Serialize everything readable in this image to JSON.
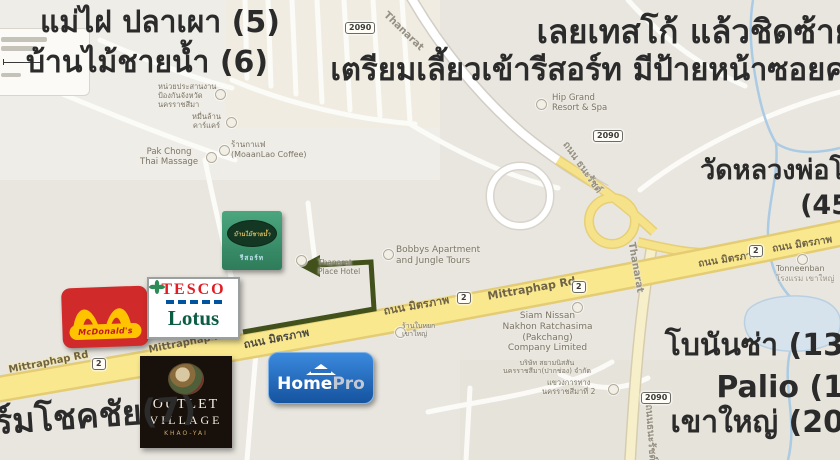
{
  "annotations": {
    "restaurant_5": "แม่ไฝ ปลาเผา (5)",
    "restaurant_6": "บ้านไม้ชายน้ำ (6)",
    "direction_line1": "เลยเทสโก้ แล้วชิดซ้าย",
    "direction_line2": "เตรียมเลี้ยวเข้ารีสอร์ท มีป้ายหน้าซอยค",
    "temple": "วัดหลวงพ่อโ",
    "temple_distance": "(45",
    "bonanza": "โบนันซ่า (13",
    "palio": "Palio (1",
    "khao_yai": "เขาใหญ่ (20",
    "farm_chokchai": "ร์มโชคชัย(7)"
  },
  "logos": {
    "mcdonalds": {
      "name": "McDonald's"
    },
    "tesco_lotus": {
      "tesco": "TESCO",
      "lotus": "Lotus"
    },
    "resort": {
      "name": "บ้านไม้ชายน้ำ",
      "sub": "รีสอร์ท"
    },
    "outlet_village": {
      "line1": "OUTLET",
      "line2": "VILLAGE",
      "line3": "KHAO-YAI"
    },
    "homepro": {
      "home": "Home",
      "pro": "Pro"
    }
  },
  "roads": {
    "labels": [
      {
        "text": "Mittraphap Rd"
      },
      {
        "text": "Mittraphap Rd"
      },
      {
        "text": "ถนน มิตรภาพ"
      },
      {
        "text": "ถนน มิตรภาพ"
      },
      {
        "text": "Mittraphap Rd"
      },
      {
        "text": "ถนน มิตรภาพ"
      },
      {
        "text": "ถนน มิตรภาพ"
      },
      {
        "text": "Thanarat"
      },
      {
        "text": "ถนน ธนะรัชต์"
      },
      {
        "text": "Thanarat"
      },
      {
        "text": "ถนนธนะรัชต์"
      }
    ],
    "shields": [
      {
        "num": "2090"
      },
      {
        "num": "2090"
      },
      {
        "num": "2090"
      },
      {
        "num": "2"
      },
      {
        "num": "2"
      },
      {
        "num": "2"
      },
      {
        "num": "2"
      }
    ]
  },
  "pois": [
    {
      "lines": [
        "Pak Chong",
        "Thai Massage"
      ]
    },
    {
      "lines": [
        "หน่วยประสานงาน",
        "ป้องกันจังหวัด",
        "นครราชสีมา"
      ]
    },
    {
      "lines": [
        "หมื่นล้าน",
        "คาร์แคร์"
      ]
    },
    {
      "lines": [
        "ร้านกาแฟ",
        "(MoaanLao Coffee)"
      ]
    },
    {
      "lines": [
        "Hip Grand",
        "Resort & Spa"
      ]
    },
    {
      "lines": [
        "Bobbys Apartment",
        "and Jungle Tours"
      ]
    },
    {
      "lines": [
        "Thanarat",
        "Place Hotel"
      ]
    },
    {
      "lines": [
        "Siam Nissan",
        "Nakhon Ratchasima",
        "(Pakchang)",
        "Company Limited"
      ]
    },
    {
      "lines": [
        "บริษัท สยามนิสสัน",
        "นครราชสีมา(ปากช่อง) จำกัด"
      ]
    },
    {
      "lines": [
        "แขวงการทาง",
        "นครราชสีมาที่ 2"
      ]
    },
    {
      "lines": [
        "Tonneenban",
        "โรงแรม เขาใหญ่"
      ]
    },
    {
      "lines": [
        "ร้านใบหยก",
        "เขาใหญ่"
      ]
    }
  ],
  "colors": {
    "map_background": "#e9e6df",
    "highway_yellow": "#f9e88e",
    "route_arrow_green": "#42511c",
    "water_blue": "#abcbe4",
    "mcdonalds_red": "#d02a2a",
    "mcdonalds_arches": "#ffc300",
    "tesco_red": "#e21c23",
    "lotus_green": "#0a5c43",
    "homepro_blue": "#15539f",
    "outlet_black": "#18100a",
    "resort_green": "#2e7c5a"
  }
}
